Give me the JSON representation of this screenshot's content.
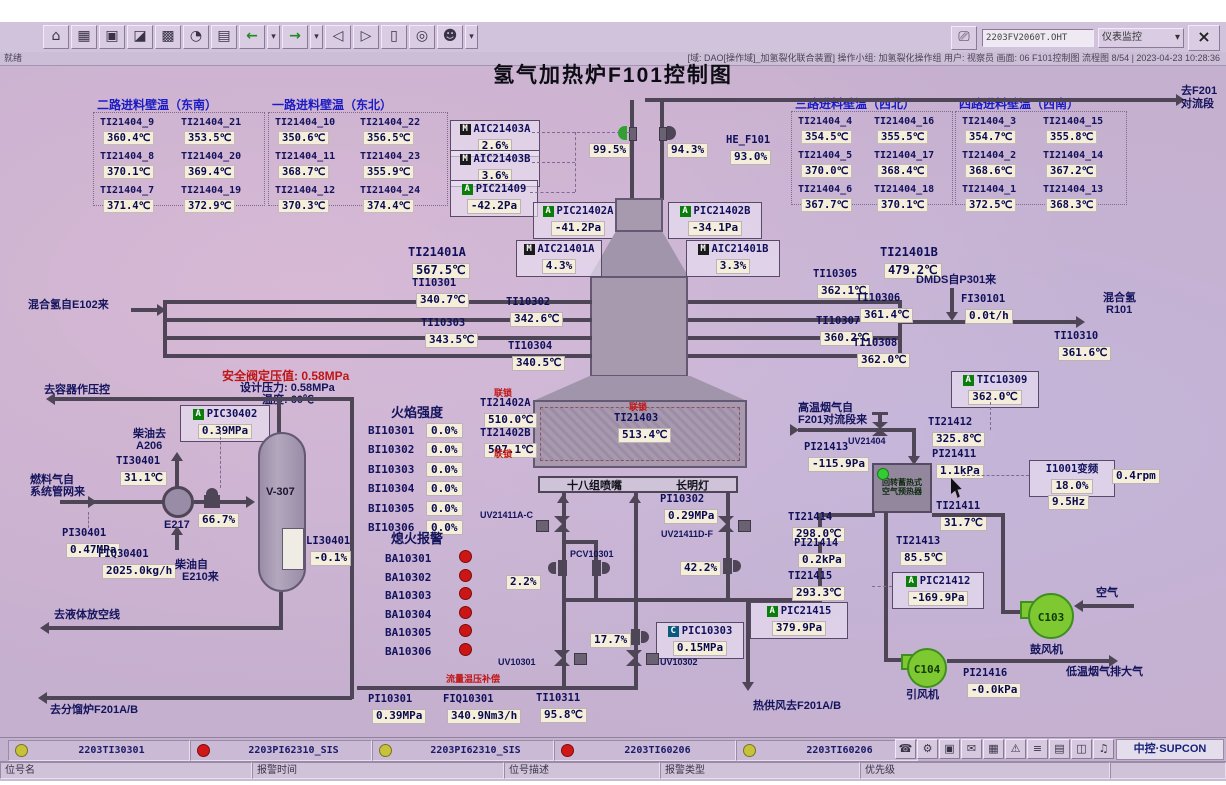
{
  "chrome": {
    "screen_field": "2203FV2060T.OHT",
    "monitor_select": "仪表监控",
    "close": "×",
    "status_left": "就绪",
    "status_right": "[域: DAO[操作域]_加氢裂化联合装置] 操作小组: 加氢裂化操作组  用户: 视察员  画面: 06 F101控制图 流程图 8/54 | 2023-04-23 10:28:36",
    "toolbar_icons": [
      {
        "name": "home-icon",
        "glyph": "⌂"
      },
      {
        "name": "report-table-icon",
        "glyph": "▦"
      },
      {
        "name": "window-icon",
        "glyph": "▣"
      },
      {
        "name": "trend-chart-icon",
        "glyph": "◪"
      },
      {
        "name": "group-display-icon",
        "glyph": "▩"
      },
      {
        "name": "history-icon",
        "glyph": "◔"
      },
      {
        "name": "log-icon",
        "glyph": "▤"
      },
      {
        "name": "back-icon",
        "glyph": "←",
        "green": true
      },
      {
        "name": "back-dropdown-icon",
        "glyph": "▾",
        "drop": true
      },
      {
        "name": "forward-icon",
        "glyph": "→",
        "green": true
      },
      {
        "name": "forward-dropdown-icon",
        "glyph": "▾",
        "drop": true
      },
      {
        "name": "page-prev-icon",
        "glyph": "◁"
      },
      {
        "name": "page-next-icon",
        "glyph": "▷"
      },
      {
        "name": "overview-icon",
        "glyph": "▯"
      },
      {
        "name": "search-icon",
        "glyph": "◎"
      },
      {
        "name": "user-icon",
        "glyph": "☻"
      },
      {
        "name": "user-dropdown-icon",
        "glyph": "▾",
        "drop": true
      }
    ]
  },
  "title": "氢气加热炉F101控制图",
  "wall_groups": [
    {
      "title": "二路进料壁温（东南）",
      "items": [
        {
          "tag": "TI21404_9",
          "value": "360.4℃"
        },
        {
          "tag": "TI21404_21",
          "value": "353.5℃"
        },
        {
          "tag": "TI21404_8",
          "value": "370.1℃"
        },
        {
          "tag": "TI21404_20",
          "value": "369.4℃"
        },
        {
          "tag": "TI21404_7",
          "value": "371.4℃"
        },
        {
          "tag": "TI21404_19",
          "value": "372.9℃"
        }
      ]
    },
    {
      "title": "一路进料壁温（东北）",
      "items": [
        {
          "tag": "TI21404_10",
          "value": "350.6℃"
        },
        {
          "tag": "TI21404_22",
          "value": "356.5℃"
        },
        {
          "tag": "TI21404_11",
          "value": "368.7℃"
        },
        {
          "tag": "TI21404_23",
          "value": "355.9℃"
        },
        {
          "tag": "TI21404_12",
          "value": "370.3℃"
        },
        {
          "tag": "TI21404_24",
          "value": "374.4℃"
        }
      ]
    },
    {
      "title": "三路进料壁温（西北）",
      "items": [
        {
          "tag": "TI21404_4",
          "value": "354.5℃"
        },
        {
          "tag": "TI21404_16",
          "value": "355.5℃"
        },
        {
          "tag": "TI21404_5",
          "value": "370.0℃"
        },
        {
          "tag": "TI21404_17",
          "value": "368.4℃"
        },
        {
          "tag": "TI21404_6",
          "value": "367.7℃"
        },
        {
          "tag": "TI21404_18",
          "value": "370.1℃"
        }
      ]
    },
    {
      "title": "四路进料壁温（西南）",
      "items": [
        {
          "tag": "TI21404_3",
          "value": "354.7℃"
        },
        {
          "tag": "TI21404_15",
          "value": "355.8℃"
        },
        {
          "tag": "TI21404_2",
          "value": "368.6℃"
        },
        {
          "tag": "TI21404_14",
          "value": "367.2℃"
        },
        {
          "tag": "TI21404_1",
          "value": "372.5℃"
        },
        {
          "tag": "TI21404_13",
          "value": "368.3℃"
        }
      ]
    }
  ],
  "inst": {
    "aic21403a": {
      "badge": "M",
      "tag": "AIC21403A",
      "value": "2.6%"
    },
    "aic21403b": {
      "badge": "M",
      "tag": "AIC21403B",
      "value": "3.6%"
    },
    "pic21409": {
      "badge": "A",
      "tag": "PIC21409",
      "value": "-42.2Pa"
    },
    "pic21402a": {
      "badge": "A",
      "tag": "PIC21402A",
      "value": "-41.2Pa"
    },
    "pic21402b": {
      "badge": "A",
      "tag": "PIC21402B",
      "value": "-34.1Pa"
    },
    "aic21401a": {
      "badge": "M",
      "tag": "AIC21401A",
      "value": "4.3%"
    },
    "aic21401b": {
      "badge": "M",
      "tag": "AIC21401B",
      "value": "3.3%"
    },
    "he_f101": {
      "tag": "HE_F101",
      "value": "93.0%"
    },
    "v995": {
      "value": "99.5%"
    },
    "v943": {
      "value": "94.3%"
    },
    "ti21401a": {
      "tag": "TI21401A",
      "value": "567.5℃"
    },
    "ti21401b": {
      "tag": "TI21401B",
      "value": "479.2℃"
    },
    "ti10301": {
      "tag": "TI10301",
      "value": "340.7℃"
    },
    "ti10302": {
      "tag": "TI10302",
      "value": "342.6℃"
    },
    "ti10303": {
      "tag": "TI10303",
      "value": "343.5℃"
    },
    "ti10304": {
      "tag": "TI10304",
      "value": "340.5℃"
    },
    "ti10305": {
      "tag": "TI10305",
      "value": "362.1℃"
    },
    "ti10306": {
      "tag": "TI10306",
      "value": "361.4℃"
    },
    "ti10307": {
      "tag": "TI10307",
      "value": "360.2℃"
    },
    "ti10308": {
      "tag": "TI10308",
      "value": "362.0℃"
    },
    "ti10310": {
      "tag": "TI10310",
      "value": "361.6℃"
    },
    "fi30101": {
      "tag": "FI30101",
      "value": "0.0t/h"
    },
    "ti21402a": {
      "tag": "TI21402A",
      "value": "510.0℃"
    },
    "ti21402b": {
      "tag": "TI21402B",
      "value": "507.1℃"
    },
    "ti21403": {
      "tag": "TI21403",
      "value": "513.4℃"
    },
    "tic10309": {
      "badge": "A",
      "tag": "TIC10309",
      "value": "362.0℃"
    },
    "pic30402": {
      "badge": "A",
      "tag": "PIC30402",
      "value": "0.39MPa"
    },
    "ti30401": {
      "tag": "TI30401",
      "value": "31.1℃"
    },
    "pi30401": {
      "tag": "PI30401",
      "value": "0.47MPa"
    },
    "fiq30401": {
      "tag": "FIQ30401",
      "value": "2025.0kg/h"
    },
    "li30401": {
      "tag": "LI30401",
      "value": "-0.1%"
    },
    "v667": {
      "value": "66.7%"
    },
    "pi10302": {
      "tag": "PI10302",
      "value": "0.29MPa"
    },
    "v22": {
      "value": "2.2%"
    },
    "v422": {
      "value": "42.2%"
    },
    "v177": {
      "value": "17.7%"
    },
    "pic10303": {
      "badge": "C",
      "tag": "PIC10303",
      "value": "0.15MPa"
    },
    "pi10301": {
      "tag": "PI10301",
      "value": "0.39MPa"
    },
    "fiq10301": {
      "tag": "FIQ10301",
      "value": "340.9Nm3/h"
    },
    "ti10311": {
      "tag": "TI10311",
      "value": "95.8℃"
    },
    "pic21415": {
      "badge": "A",
      "tag": "PIC21415",
      "value": "379.9Pa"
    },
    "ti21412": {
      "tag": "TI21412",
      "value": "325.8℃"
    },
    "pi21413": {
      "tag": "PI21413",
      "value": "-115.9Pa"
    },
    "pi21411": {
      "tag": "PI21411",
      "value": "1.1kPa"
    },
    "ti21411": {
      "tag": "TI21411",
      "value": "31.7℃"
    },
    "ti21414": {
      "tag": "TI21414",
      "value": "298.0℃"
    },
    "pi21414": {
      "tag": "PI21414",
      "value": "0.2kPa"
    },
    "ti21415": {
      "tag": "TI21415",
      "value": "293.3℃"
    },
    "ti21413": {
      "tag": "TI21413",
      "value": "85.5℃"
    },
    "pic21412": {
      "badge": "A",
      "tag": "PIC21412",
      "value": "-169.9Pa"
    },
    "pi21416": {
      "tag": "PI21416",
      "value": "-0.0kPa"
    },
    "vfd": {
      "tag": "I1001变频",
      "value": "18.0%"
    },
    "vfd_hz": {
      "value": "9.5Hz"
    },
    "vfd_rpm": {
      "value": "0.4rpm"
    }
  },
  "flame": {
    "title": "火焰强度",
    "rows": [
      {
        "tag": "BI10301",
        "value": "0.0%"
      },
      {
        "tag": "BI10302",
        "value": "0.0%"
      },
      {
        "tag": "BI10303",
        "value": "0.0%"
      },
      {
        "tag": "BI10304",
        "value": "0.0%"
      },
      {
        "tag": "BI10305",
        "value": "0.0%"
      },
      {
        "tag": "BI10306",
        "value": "0.0%"
      }
    ]
  },
  "flameout": {
    "title": "熄火报警",
    "rows": [
      "BA10301",
      "BA10302",
      "BA10303",
      "BA10304",
      "BA10305",
      "BA10306"
    ]
  },
  "labels": {
    "interlock": "联锁",
    "to_f201_l1": "去F201",
    "to_f201_l2": "对流段",
    "mix_h2_in": "混合氢自E102来",
    "dmds": "DMDS自P301来",
    "mix_h2": "混合氢",
    "r101": "R101",
    "to_vessel": "去容器作压控",
    "sv_set": "安全阀定压值: 0.58MPa",
    "design_p": "设计压力: 0.58MPa",
    "design_t": "温度: 60℃",
    "diesel_to": "柴油去",
    "a206": "A206",
    "fuel_from1": "燃料气自",
    "fuel_from2": "系统管网来",
    "e217": "E217",
    "v307": "V-307",
    "diesel_from": "柴油自",
    "e210": "E210来",
    "to_flare": "去液体放空线",
    "to_frac": "去分馏炉F201A/B",
    "burners": "十八组喷嘴",
    "pilot": "长明灯",
    "comp": "流量温压补偿",
    "hot_air": "热供风去F201A/B",
    "hot_flue1": "高温烟气自",
    "hot_flue2": "F201对流段来",
    "uv21404": "UV21404",
    "uv21411ac": "UV21411A-C",
    "uv21411df": "UV21411D-F",
    "pcv10301": "PCV10301",
    "uv10301": "UV10301",
    "uv10302": "UV10302",
    "preheater1": "回转蓄热式",
    "preheater2": "空气预热器",
    "c103": "C103",
    "blower": "鼓风机",
    "air": "空气",
    "c104": "C104",
    "idfan": "引风机",
    "cold_flue": "低温烟气排大气"
  },
  "alarms": [
    {
      "color": "yellow",
      "tag": "2203TI30301"
    },
    {
      "color": "red",
      "tag": "2203PI62310_SIS"
    },
    {
      "color": "yellow",
      "tag": "2203PI62310_SIS"
    },
    {
      "color": "red",
      "tag": "2203TI60206"
    },
    {
      "color": "yellow",
      "tag": "2203TI60206"
    }
  ],
  "alarm_fields": [
    "位号名",
    "报警时间",
    "位号描述",
    "报警类型",
    "优先级"
  ],
  "tray_icons": [
    {
      "name": "phone-icon",
      "glyph": "☎"
    },
    {
      "name": "gear-icon",
      "glyph": "⚙"
    },
    {
      "name": "monitor-icon",
      "glyph": "▣"
    },
    {
      "name": "mail-icon",
      "glyph": "✉"
    },
    {
      "name": "calendar-icon",
      "glyph": "▦"
    },
    {
      "name": "warning-icon",
      "glyph": "⚠"
    },
    {
      "name": "menu-icon",
      "glyph": "≡"
    },
    {
      "name": "report-icon",
      "glyph": "▤"
    },
    {
      "name": "windows-icon",
      "glyph": "◫"
    },
    {
      "name": "sound-icon",
      "glyph": "♫"
    }
  ],
  "logo": "中控·SUPCON"
}
